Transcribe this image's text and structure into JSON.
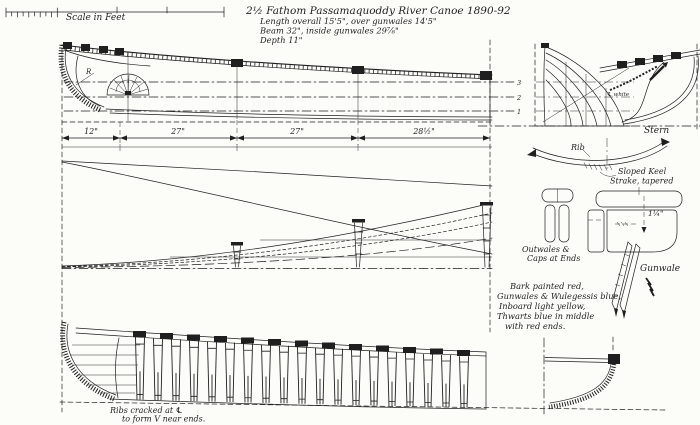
{
  "colors": {
    "ink": "#1f1f1f",
    "paper": "#fcfcf9"
  },
  "scale_bar": {
    "label": "Scale in Feet"
  },
  "title_block": {
    "line1": "2½ Fathom Passamaquoddy River Canoe  1890-92",
    "line2": "Length overall 15'5\", over gunwales 14'5\"",
    "line3": "Beam  32\",  inside gunwales 29⅞\"",
    "line4": "Depth  11\""
  },
  "profile_view": {
    "stem_label": "R",
    "waterline_labels": [
      "3",
      "2",
      "1"
    ]
  },
  "dimensions": {
    "segments": [
      "12\"",
      "27\"",
      "27\"",
      "28½\""
    ]
  },
  "stern_view": {
    "label": "Stern",
    "centerline_note": "℄ white"
  },
  "rib_detail": {
    "label": "Rib",
    "note_line1": "Sloped Keel",
    "note_line2": "Strake, tapered"
  },
  "outwales_detail": {
    "label_line1": "Outwales &",
    "label_line2": "Caps at Ends"
  },
  "gunwale_detail": {
    "label": "Gunwale",
    "dimension": "1¼\""
  },
  "paint_notes": {
    "lines": [
      "Bark painted red,",
      "Gunwales & Wulegessis blue,",
      "Inboard light yellow,",
      "Thwarts blue in middle",
      "with red ends."
    ]
  },
  "ribs_view": {
    "caption_line1": "Ribs cracked at ℄",
    "caption_line2": "to form V near ends."
  }
}
